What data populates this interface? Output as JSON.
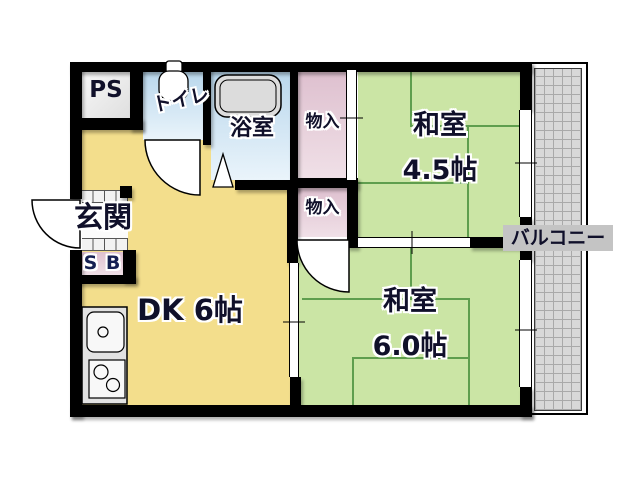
{
  "rooms": {
    "ps": {
      "label": "PS"
    },
    "toilet": {
      "label": "トイレ"
    },
    "bath": {
      "label": "浴室"
    },
    "closet_upper": {
      "label": "物入"
    },
    "closet_lower": {
      "label": "物入"
    },
    "washitsu_45": {
      "name": "和室",
      "size": "4.5帖"
    },
    "washitsu_60": {
      "name": "和室",
      "size": "6.0帖"
    },
    "dk": {
      "label": "DK 6帖"
    },
    "genkan": {
      "label": "玄関"
    },
    "shoebox": {
      "label": "S B"
    },
    "balcony": {
      "label": "バルコニー"
    }
  },
  "colors": {
    "wall": "#000000",
    "dk_floor": "#F3DE8C",
    "tatami": "#CBE5A5",
    "tatami_line": "#5F9E4E",
    "wet_room_top": "#B9D7EC",
    "wet_room_bottom": "#EAF4FB",
    "closet_top": "#DEC0CF",
    "closet_bottom": "#F0E0E7",
    "service_gray": "#EDEDED",
    "balcony_deck": "#D8D8D8",
    "label_band": "#C4C4C4",
    "text": "#10102A"
  }
}
